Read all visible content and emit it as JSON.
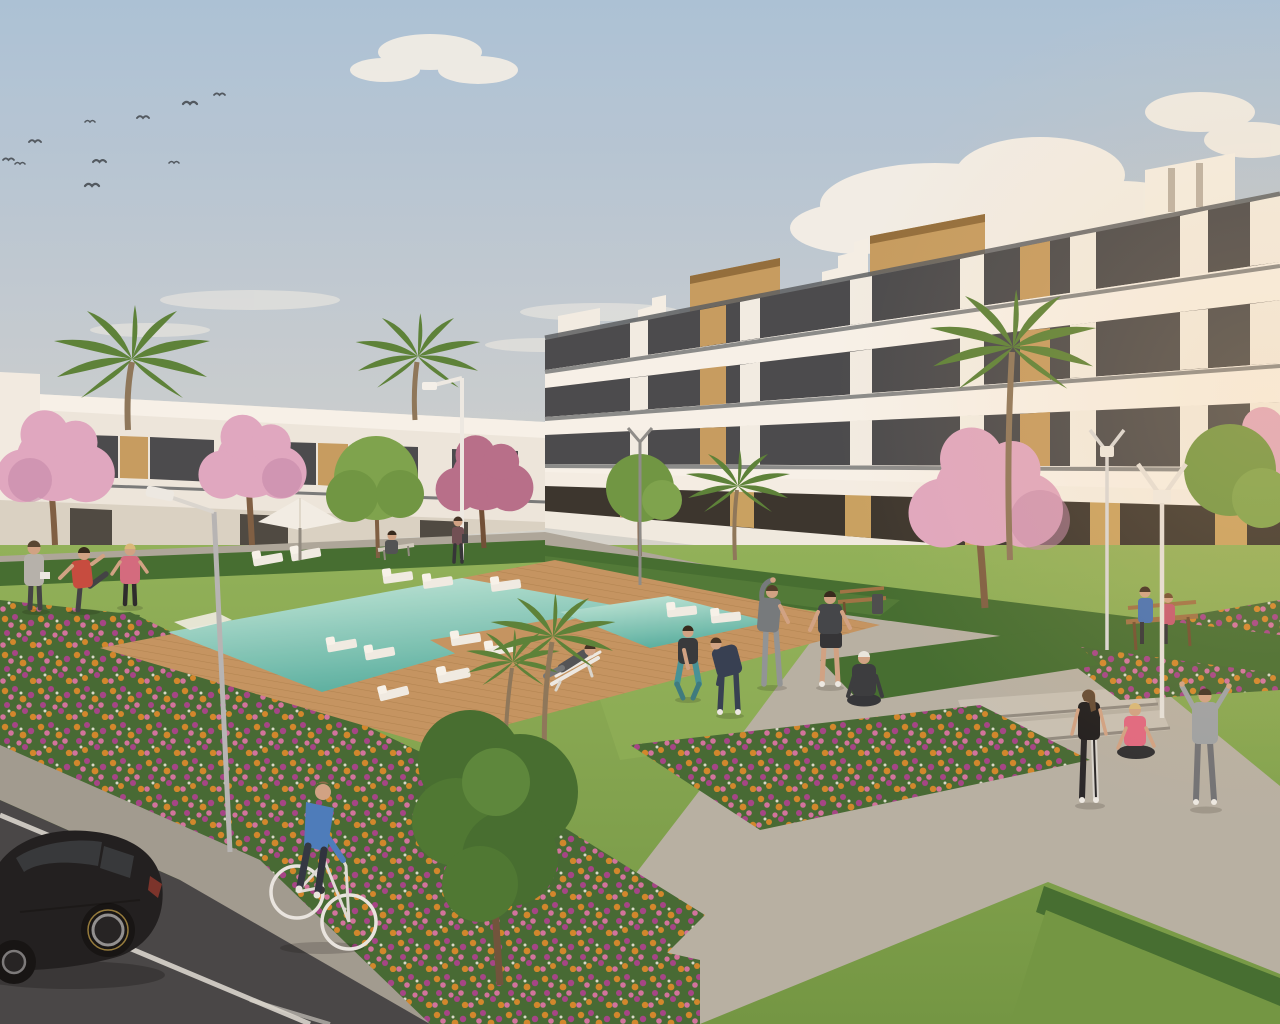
{
  "meta": {
    "type": "architectural-3d-render",
    "subject": "Modern residential apartment complex with communal pool and landscaped gardens",
    "lighting": "warm late-afternoon sun from the right",
    "width_px": 1280,
    "height_px": 1024
  },
  "palette": {
    "sky_top": "#a8c1d9",
    "sky_mid": "#c6cdd2",
    "sky_horizon": "#e4dac8",
    "cloud": "#f5f1ea",
    "facade": "#f0ebe3",
    "parapet": "#f7f3ec",
    "parapet_shadow": "#cfc8bd",
    "rail_dark": "#565b60",
    "glass": "#43454a",
    "wood": "#c49a5e",
    "wood_dark": "#8f6a38",
    "tan_column": "#c7a05f",
    "storefront": "#332f2a",
    "hedge": "#3e6a2d",
    "hedge_light": "#547f38",
    "grass": "#6d9440",
    "grass_light": "#8db057",
    "foliage": "#3f6a2c",
    "foliage_light": "#568438",
    "palm": "#567f35",
    "blossom": "#dfa6c2",
    "blossom_deep": "#c387ab",
    "trunk": "#7a5a40",
    "pool_light": "#c6ebdf",
    "pool_deep": "#56b0a2",
    "deck": "#c2925f",
    "deck_dark": "#9e713f",
    "walkway": "#aaa59a",
    "path": "#b5afa4",
    "sidewalk": "#9e9990",
    "steps": "#c6c0b5",
    "road": "#414144",
    "road_line": "#d8d6d0",
    "flower_orange": "#d08428",
    "flower_pink": "#d06f9e",
    "flower_magenta": "#a23f86",
    "lamp_grey": "#b4b4b6",
    "lamp_white": "#eceae6",
    "car_black": "#18181b",
    "car_glass": "#2e3237",
    "skin": "#cfa183",
    "bench_wood": "#9c6f42"
  },
  "sky": {
    "birds_count": 10,
    "clouds": "large cumulus cluster right of centre, small puffs upper-left, low wisps near horizon"
  },
  "buildings": {
    "right_block": {
      "name": "four-storey apartment block",
      "floors": 4,
      "features": [
        "continuous white balcony bands",
        "glass balustrades",
        "dark tinted glazing",
        "vertical timber slat panels",
        "timber-clad rooftop stair towers",
        "stepped stair gables",
        "ochre ground-floor columns",
        "glazed ground-floor units"
      ]
    },
    "left_row": {
      "name": "two-storey terraced houses",
      "floors": 2,
      "features": [
        "white flat-roof terraces",
        "timber accents",
        "dark window openings"
      ]
    }
  },
  "amenities": {
    "pool": {
      "shape": "long rectangular pool with timber deck, swim bridge and secondary basin",
      "water": "turquoise",
      "sun_loungers": 12,
      "parasols": 1,
      "deck_chairs": 1,
      "in_pool_daybeds": 2
    },
    "benches": 3,
    "street_lamps": 5,
    "litter_bins": 1,
    "stone_steps": 2
  },
  "vegetation": {
    "palm_trees": 6,
    "pink_blossom_trees": 5,
    "green_trees": 4,
    "hedge_rows": 4,
    "flower_beds": 4,
    "flower_colors": [
      "orange",
      "pink",
      "magenta"
    ]
  },
  "people": [
    {
      "id": "walker-grey",
      "desc": "person in grey top with towel, seen from behind",
      "area": "pool walkway left"
    },
    {
      "id": "stretcher-red",
      "desc": "man in red t-shirt stretching his leg",
      "area": "pool walkway left"
    },
    {
      "id": "jogger-pink",
      "desc": "woman in pink top and black leggings",
      "area": "pool walkway left"
    },
    {
      "id": "lounging-man",
      "desc": "man reclining on white deck chair",
      "area": "lawn"
    },
    {
      "id": "squat-teal",
      "desc": "woman in teal leggings squatting",
      "area": "lawn"
    },
    {
      "id": "tracksuit-bend",
      "desc": "person in navy tracksuit bending forward",
      "area": "lawn"
    },
    {
      "id": "side-stretch-grey",
      "desc": "man in grey tee, arm arched overhead",
      "area": "lawn"
    },
    {
      "id": "shorts-man",
      "desc": "man in dark tee and shorts",
      "area": "lawn"
    },
    {
      "id": "yoga-cap",
      "desc": "woman seated cross-legged, white cap",
      "area": "lawn"
    },
    {
      "id": "standing-vest",
      "desc": "woman in black vest and striped leggings",
      "area": "steps plaza"
    },
    {
      "id": "seated-pink",
      "desc": "woman in pink top seated cross-legged on steps",
      "area": "steps plaza"
    },
    {
      "id": "arms-up-hoodie",
      "desc": "person in grey hoodie, both arms raised",
      "area": "steps plaza"
    },
    {
      "id": "bench-man-blue",
      "desc": "man in blue shirt on bench",
      "area": "right promenade"
    },
    {
      "id": "bench-woman-pink",
      "desc": "woman in pink on bench",
      "area": "right promenade"
    },
    {
      "id": "walking-woman",
      "desc": "small figure walking by the terraces",
      "area": "background walkway"
    },
    {
      "id": "cyclist",
      "desc": "man in blue jumper riding a white bicycle",
      "area": "foreground pavement"
    }
  ],
  "vehicles": [
    {
      "type": "hatchback car",
      "color": "black",
      "state": "parked beside white bay lines"
    },
    {
      "type": "bicycle",
      "color": "white",
      "state": "ridden toward foreground"
    }
  ],
  "ground": {
    "road": "dark asphalt with white parking bay lines, lower-left",
    "paths": "light grey paver walkways and plaza sweeping to lower-right",
    "lawn": "manicured green lawns edged by clipped hedges and flower beds"
  }
}
